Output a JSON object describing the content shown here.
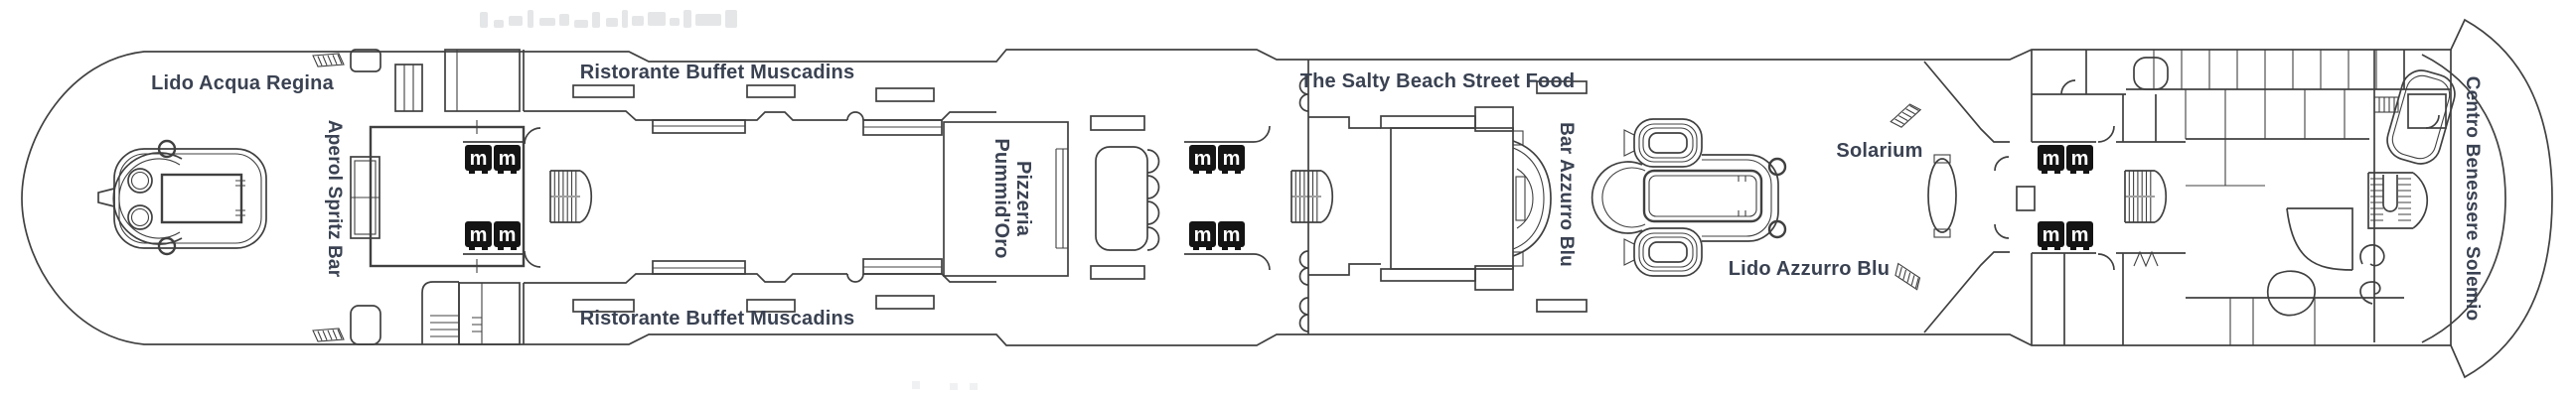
{
  "deck": {
    "labels": {
      "lido_acqua_regina": "Lido Acqua Regina",
      "aperol_spritz_bar": "Aperol Spritz Bar",
      "buffet_top": "Ristorante Buffet Muscadins",
      "buffet_bottom": "Ristorante Buffet Muscadins",
      "pizzeria_line1": "Pizzeria",
      "pizzeria_line2": "Pummid'Oro",
      "salty_beach": "The Salty Beach Street Food",
      "bar_azzurro_blu": "Bar Azzurro Blu",
      "solarium": "Solarium",
      "lido_azzurro_blu": "Lido Azzurro Blu",
      "centro_benessere": "Centro Benessere Solemio"
    },
    "icons": {
      "elevator_glyph": "m"
    },
    "colors": {
      "line": "#404040",
      "text": "#3a4252",
      "elevator_bg": "#141414",
      "elevator_glyph": "#ffffff",
      "ghost": "#cdd1d6",
      "background": "#ffffff"
    }
  }
}
